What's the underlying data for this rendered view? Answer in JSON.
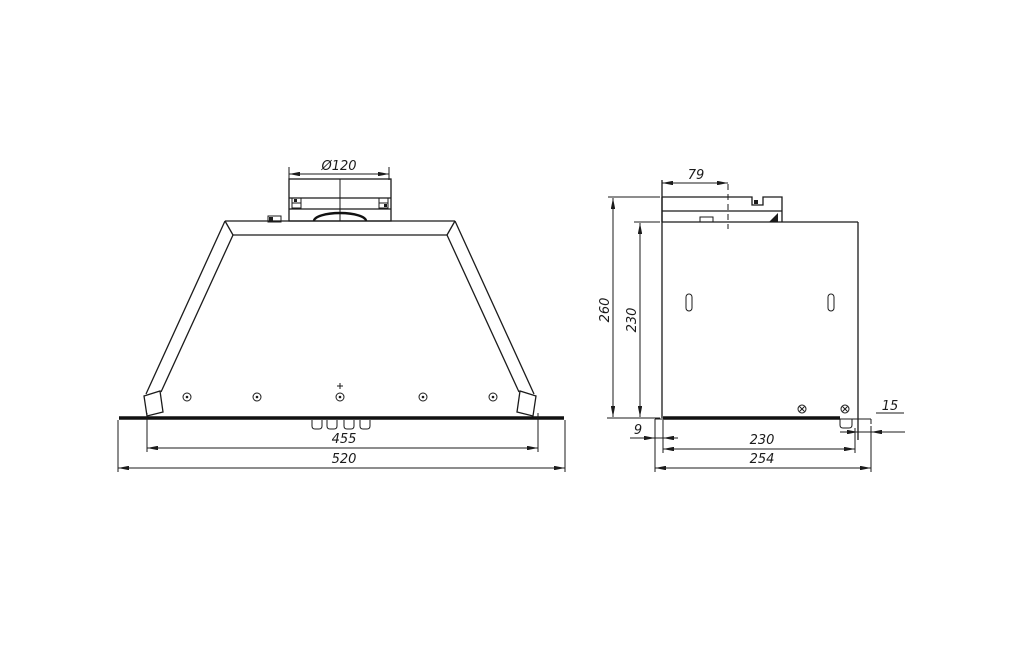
{
  "drawing": {
    "background_color": "#ffffff",
    "line_color": "#1b1b1b",
    "views": {
      "front": {
        "label": "front-view-of-built-in-cooker-hood",
        "dimensions": {
          "duct_diameter": "Ø120",
          "inner_width": "455",
          "overall_width": "520"
        }
      },
      "side": {
        "label": "side-view-of-built-in-cooker-hood",
        "dimensions": {
          "duct_offset": "79",
          "overall_height": "260",
          "body_height": "230",
          "back_offset": "9",
          "body_depth": "230",
          "overall_depth": "254",
          "front_offset": "15"
        }
      }
    }
  }
}
